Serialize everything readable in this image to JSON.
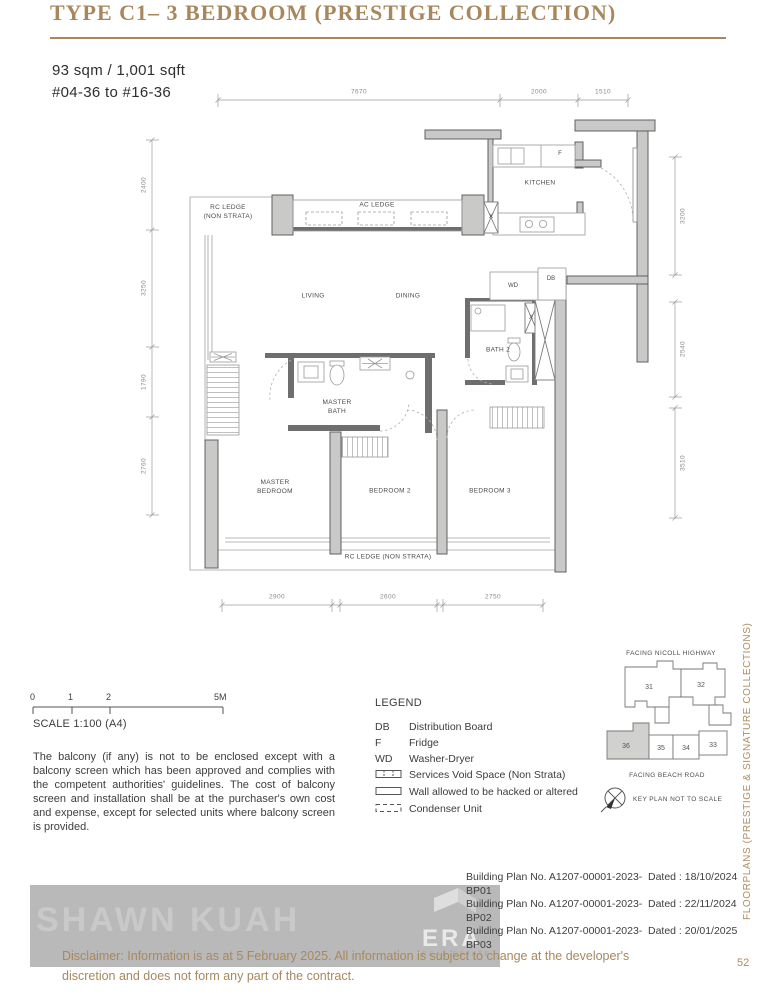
{
  "page": {
    "title": "TYPE C1– 3 BEDROOM (PRESTIGE COLLECTION)",
    "side_label": "FLOORPLANS (PRESTIGE & SIGNATURE COLLECTIONS)",
    "page_number": "52"
  },
  "unit": {
    "area": "93 sqm / 1,001 sqft",
    "stack": "#04-36 to #16-36"
  },
  "plan": {
    "labels": {
      "rc_ledge_top": "RC LEDGE\n(NON STRATA)",
      "ac_ledge": "AC LEDGE",
      "kitchen": "KITCHEN",
      "living": "LIVING",
      "dining": "DINING",
      "bath2": "BATH 2",
      "master_bath": "MASTER\nBATH",
      "master_bedroom": "MASTER\nBEDROOM",
      "bedroom2": "BEDROOM 2",
      "bedroom3": "BEDROOM 3",
      "rc_ledge_bottom": "RC LEDGE (NON STRATA)",
      "f": "F",
      "wd": "WD",
      "db": "DB",
      "x": "X"
    },
    "dims": {
      "top": [
        "7670",
        "2000",
        "1510"
      ],
      "left": [
        "2400",
        "3250",
        "1790",
        "2760"
      ],
      "right": [
        "3200",
        "2540",
        "3510"
      ],
      "bottom": [
        "2900",
        "2600",
        "2750"
      ]
    }
  },
  "scale": {
    "ticks": [
      "0",
      "1",
      "2",
      "5M"
    ],
    "caption": "SCALE 1:100 (A4)"
  },
  "balcony_note": "The balcony (if any) is not to be enclosed except with a balcony screen which has been approved and complies with the competent authorities' guidelines. The cost of balcony screen and installation shall be at the purchaser's own cost and expense, except for selected units where balcony screen is provided.",
  "legend": {
    "title": "LEGEND",
    "items": [
      {
        "key": "DB",
        "desc": "Distribution Board"
      },
      {
        "key": "F",
        "desc": "Fridge"
      },
      {
        "key": "WD",
        "desc": "Washer-Dryer"
      },
      {
        "key": "",
        "desc": "Services Void Space (Non Strata)"
      },
      {
        "key": "",
        "desc": "Wall allowed to be hacked or altered"
      },
      {
        "key": "",
        "desc": "Condenser Unit"
      }
    ]
  },
  "key_plan": {
    "top_label": "FACING NICOLL HIGHWAY",
    "bottom_label": "FACING BEACH ROAD",
    "note": "KEY PLAN NOT TO SCALE",
    "units": [
      "31",
      "32",
      "36",
      "35",
      "34",
      "33"
    ],
    "highlighted_unit": "36"
  },
  "building_plans": [
    {
      "no": "Building Plan No. A1207-00001-2023-BP01",
      "dated": "Dated : 18/10/2024"
    },
    {
      "no": "Building Plan No. A1207-00001-2023-BP02",
      "dated": "Dated : 22/11/2024"
    },
    {
      "no": "Building Plan No. A1207-00001-2023-BP03",
      "dated": "Dated : 20/01/2025"
    }
  ],
  "watermark": {
    "name": "SHAWN KUAH",
    "logo": "ERA",
    "logo_sub": "REAL ESTATE"
  },
  "footer_disclaimer": "Disclaimer: Information is as at 5 February 2025. All information is subject to change at the developer's discretion and does not form any part of the contract.",
  "colors": {
    "accent_gold": "#a8875c",
    "wall_gray": "#c9c9c7",
    "wall_dark": "#606060",
    "highlight_unit": "#d1d1cf",
    "watermark_gray": "#b9b9b9",
    "footer_text": "#a8885e"
  }
}
